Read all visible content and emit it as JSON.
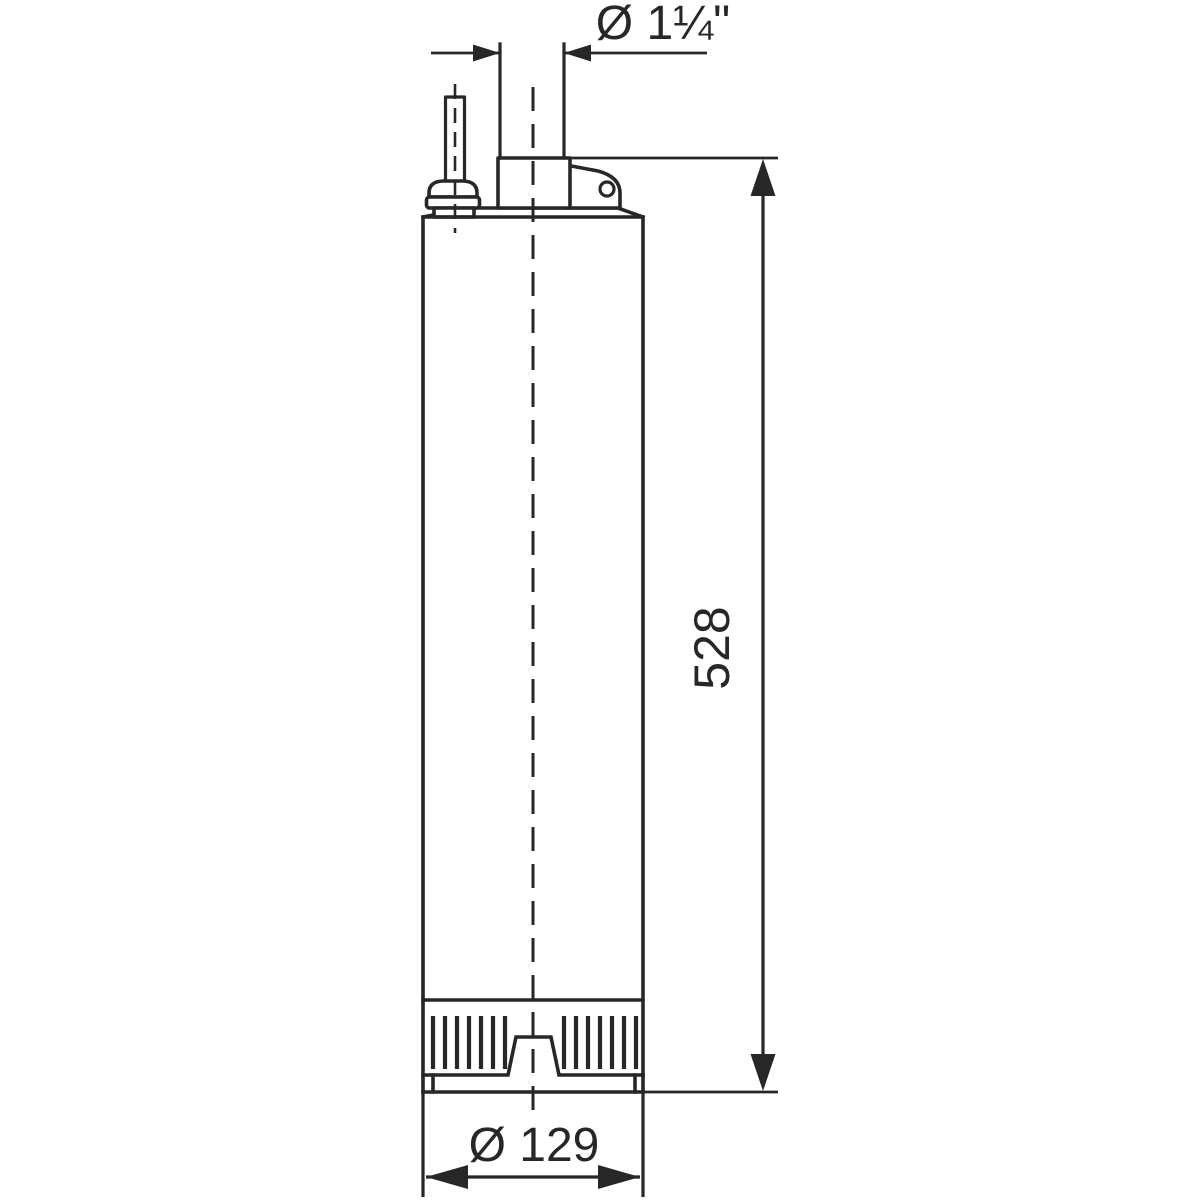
{
  "drawing": {
    "dimensions": {
      "outlet": {
        "label": "Ø 1¼\""
      },
      "height": {
        "label": "528"
      },
      "diameter": {
        "label": "Ø 129"
      }
    },
    "colors": {
      "line": "#272727",
      "background": "#ffffff"
    }
  }
}
